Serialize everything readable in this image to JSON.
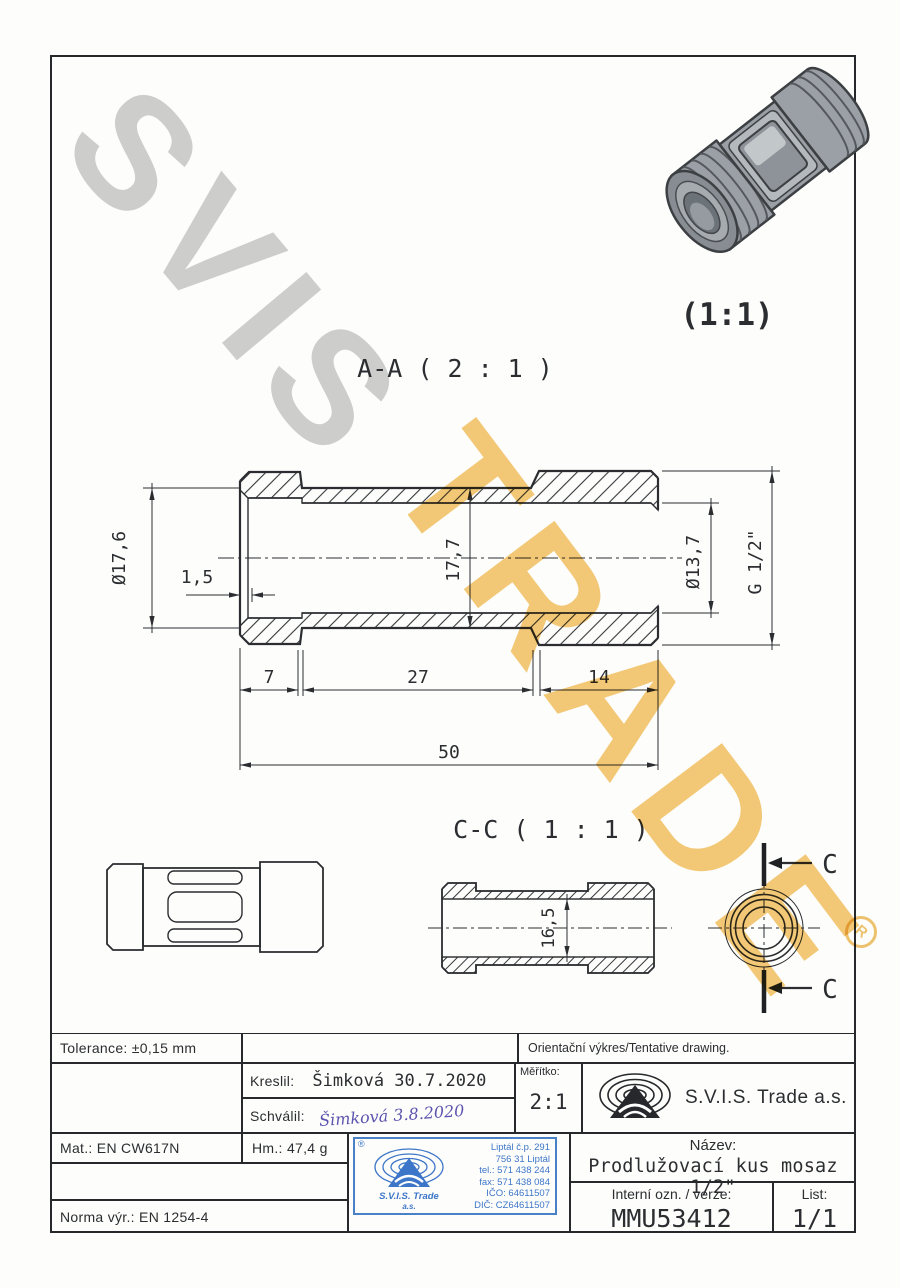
{
  "watermark": {
    "word1": "SVIS",
    "word2": "TRADE",
    "registered": "R"
  },
  "views": {
    "iso_scale": "(1:1)",
    "section_a": "A-A ( 2 : 1 )",
    "section_c": "C-C ( 1 : 1 )",
    "cut_label": "C"
  },
  "dims": {
    "od_left": "Ø17,6",
    "chamfer": "1,5",
    "mid_od": "17,7",
    "bore": "Ø13,7",
    "thread": "G 1/2\"",
    "len_a": "7",
    "len_b": "27",
    "len_c": "14",
    "len_total": "50",
    "cc_od": "16,5"
  },
  "titleblock": {
    "tolerance": "Tolerance: ±0,15 mm",
    "orientacni": "Orientační výkres/Tentative drawing.",
    "kreslil_label": "Kreslil:",
    "kreslil_value": "Šimková 30.7.2020",
    "schvalil_label": "Schválil:",
    "schvalil_value": "Šimková 3.8.2020",
    "meritko_label": "Měřítko:",
    "meritko_value": "2:1",
    "company": "S.V.I.S. Trade a.s.",
    "mat": "Mat.: EN CW617N",
    "hm": "Hm.: 47,4 g",
    "norma": "Norma výr.: EN 1254-4",
    "nazev_label": "Název:",
    "nazev_value": "Prodlužovací kus mosaz 1/2\"",
    "interni_label": "Interní ozn. / verze:",
    "interni_value": "MMU53412",
    "list_label": "List:",
    "list_value": "1/1"
  },
  "stamp": {
    "registered": "®",
    "address1": "Liptál č.p. 291",
    "address2": "756 31 Liptál",
    "tel": "tel.: 571 438 244",
    "fax": "fax: 571 438 084",
    "ico": "IČO: 64611507",
    "dic": "DIČ: CZ64611507",
    "company": "S.V.I.S. Trade",
    "suffix": "a.s."
  },
  "colors": {
    "line": "#2b2d30",
    "stamp_blue": "#3d76c8",
    "watermark_gray": "#cfcfcf",
    "watermark_yellow": "#f2bd55",
    "signature_ink": "#5b54ae"
  }
}
